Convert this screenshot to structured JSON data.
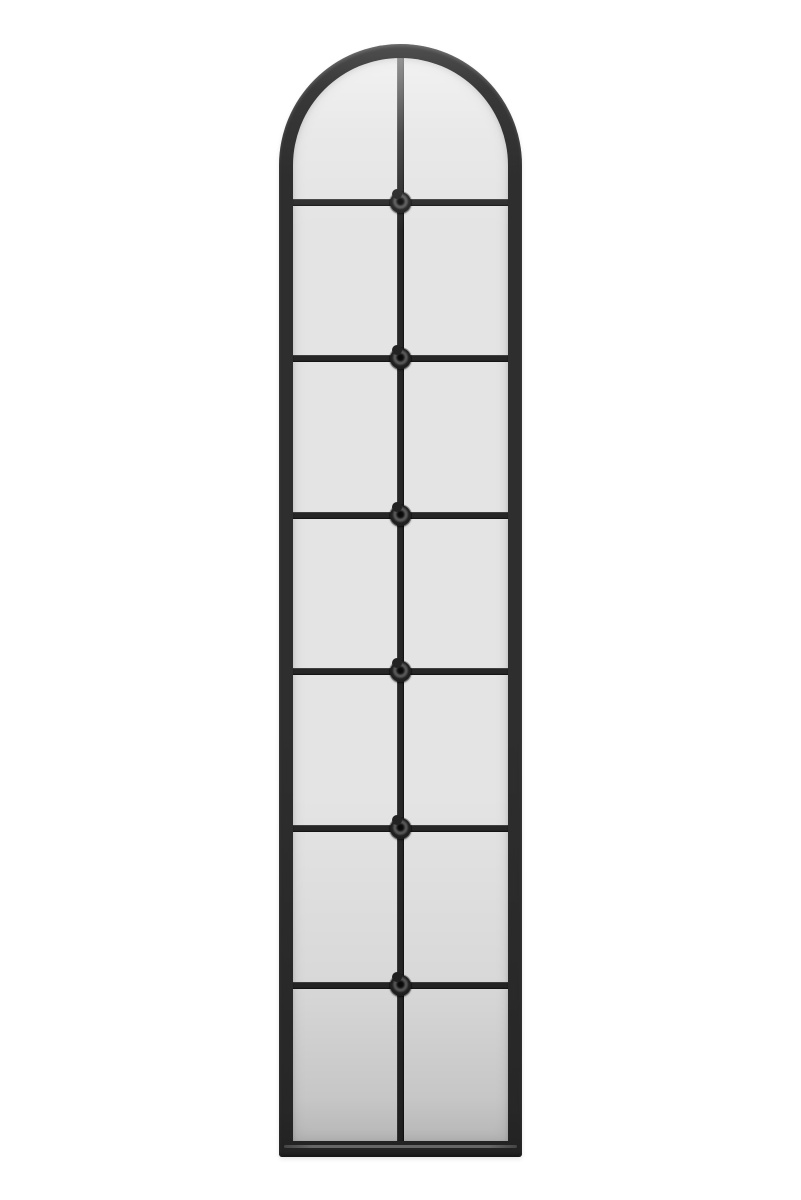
{
  "scene": {
    "type": "product-photo",
    "subject": "Tall arched window-pane wall mirror with black metal frame on plain white background",
    "background_color": "#ffffff"
  },
  "mirror": {
    "shape": "arched-top",
    "grid": {
      "rows": 7,
      "columns": 2,
      "pane_count": 14
    },
    "horizontal_mullions": 6,
    "vertical_mullions": 1,
    "rosette_count": 6,
    "colors": {
      "frame": "#2e2e2e",
      "frame_highlight": "#4f4f4f",
      "glass": "#e4e4e4",
      "glass_top": "#ededed",
      "glass_bottom": "#c9c9c9",
      "mullion": "#262626",
      "rosette": "#1e1e1e",
      "rosette_ring": "#565656",
      "background": "#ffffff"
    }
  }
}
